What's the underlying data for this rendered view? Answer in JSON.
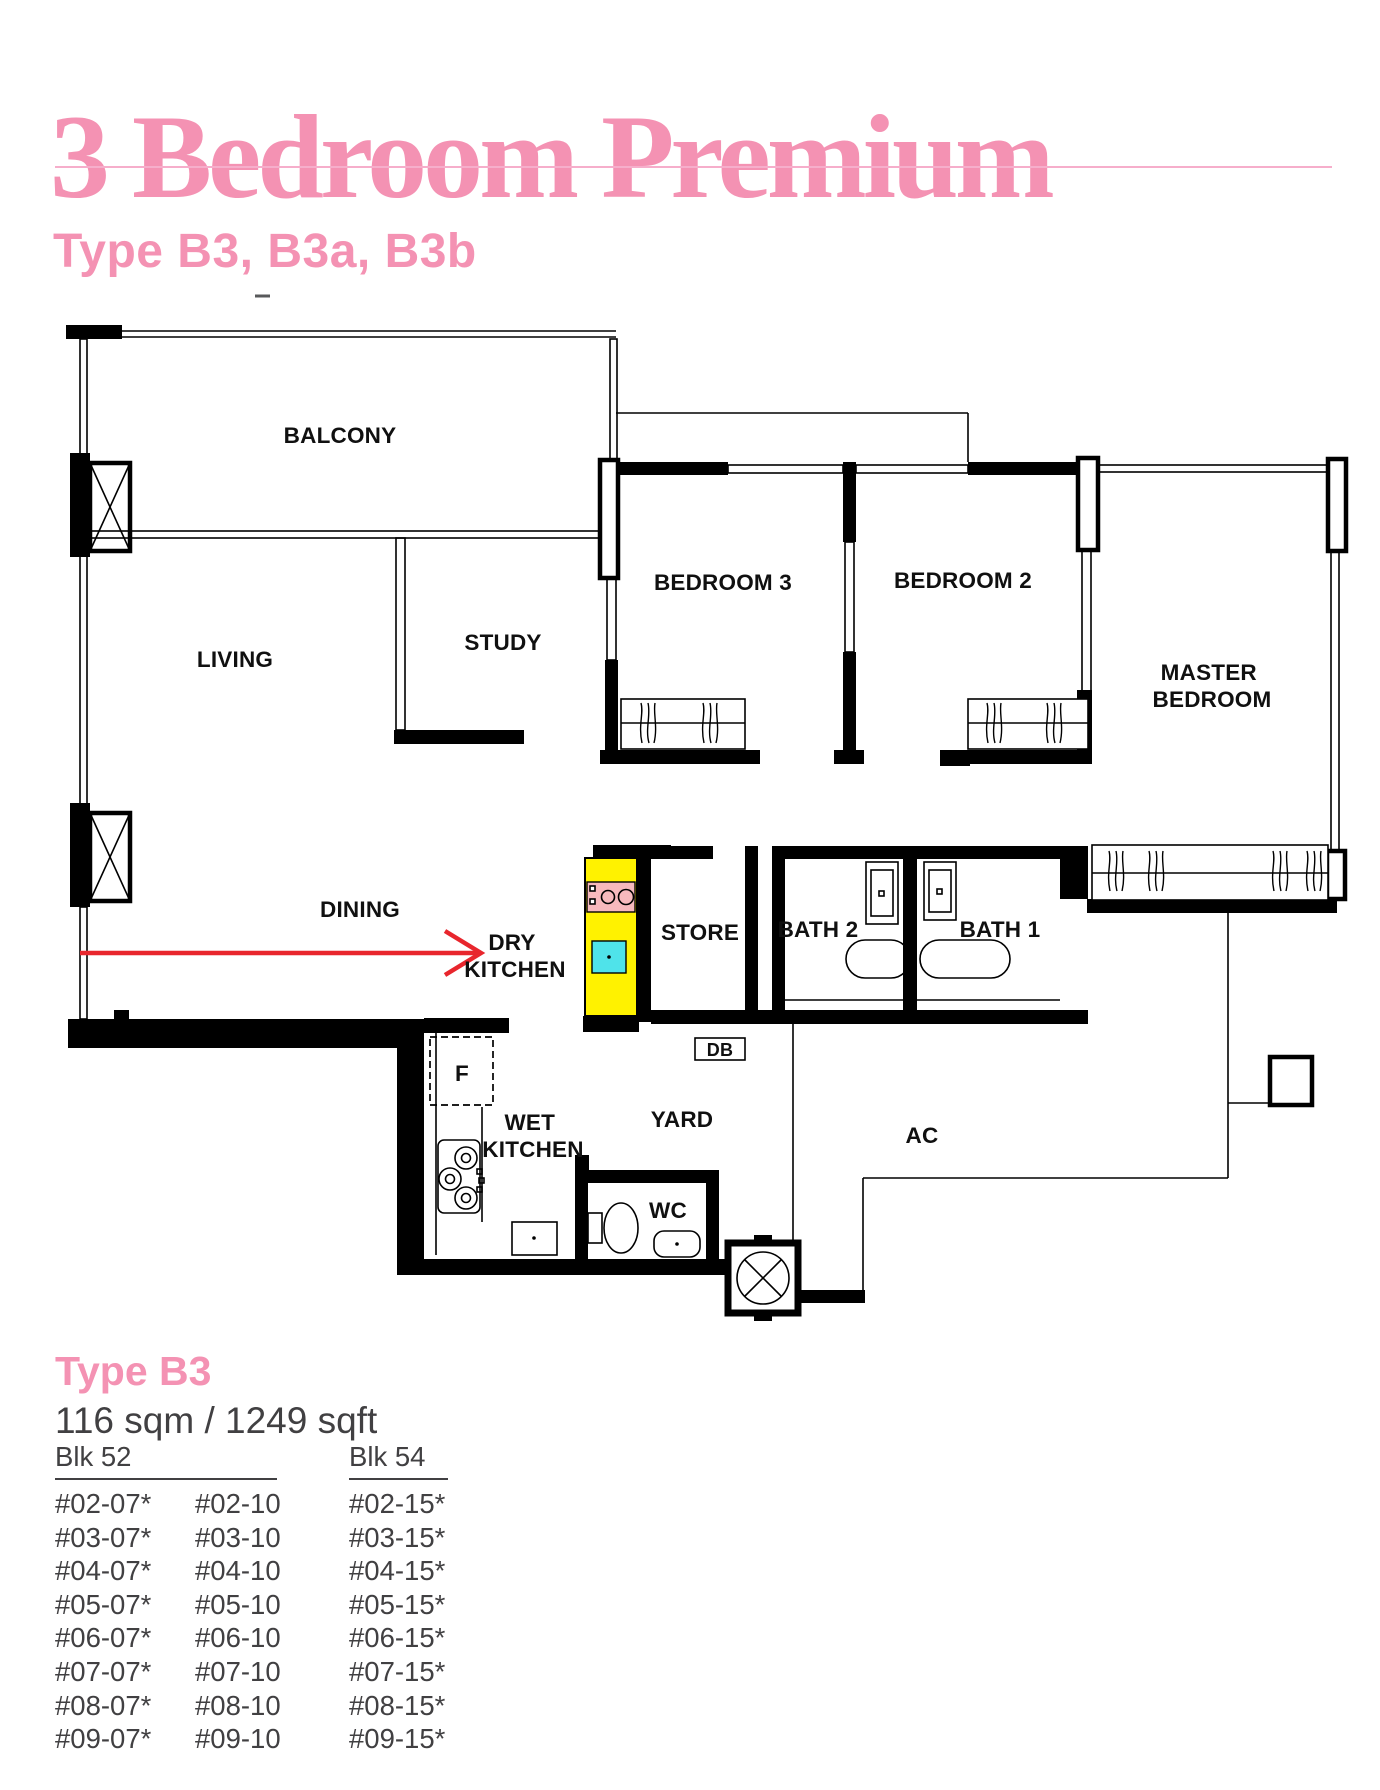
{
  "header": {
    "title": "3 Bedroom Premium",
    "subtitle": "Type B3, B3a, B3b"
  },
  "floor_plan": {
    "labels": {
      "balcony": "BALCONY",
      "living": "LIVING",
      "study": "STUDY",
      "bedroom3": "BEDROOM 3",
      "bedroom2": "BEDROOM 2",
      "master": [
        "MASTER",
        "BEDROOM"
      ],
      "dining": "DINING",
      "dry_kitchen": [
        "DRY",
        "KITCHEN"
      ],
      "store": "STORE",
      "bath2": "BATH 2",
      "bath1": "BATH 1",
      "db": "DB",
      "fridge": "F",
      "wet_kitchen": [
        "WET",
        "KITCHEN"
      ],
      "yard": "YARD",
      "wc": "WC",
      "ac": "AC"
    }
  },
  "unit_info": {
    "type_name": "Type B3",
    "area": "116 sqm / 1249 sqft"
  },
  "availability": {
    "blocks": [
      {
        "name": "Blk 52",
        "columns": [
          [
            "#02-07*",
            "#03-07*",
            "#04-07*",
            "#05-07*",
            "#06-07*",
            "#07-07*",
            "#08-07*",
            "#09-07*"
          ],
          [
            "#02-10",
            "#03-10",
            "#04-10",
            "#05-10",
            "#06-10",
            "#07-10",
            "#08-10",
            "#09-10"
          ]
        ]
      },
      {
        "name": "Blk 54",
        "columns": [
          [
            "#02-15*",
            "#03-15*",
            "#04-15*",
            "#05-15*",
            "#06-15*",
            "#07-15*",
            "#08-15*",
            "#09-15*"
          ]
        ]
      }
    ]
  },
  "colors": {
    "accent_pink": "#F492B3",
    "text_dark": "#414042",
    "counter_yellow": "#FFF200",
    "sink_cyan": "#4FE3EA",
    "stove_pink": "#F7B9BD",
    "arrow_red": "#E8262D"
  }
}
